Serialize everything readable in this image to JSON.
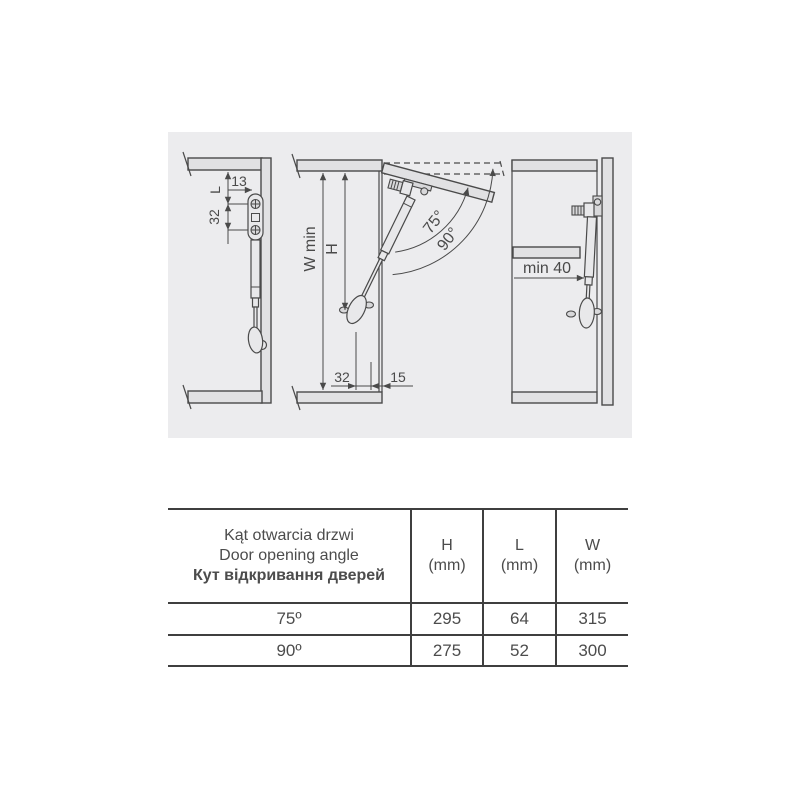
{
  "colors": {
    "page_bg": "#ffffff",
    "diagram_bg": "#ececee",
    "panel_fill": "#e1e1e3",
    "line": "#4a4a4a",
    "text": "#4c4c4c"
  },
  "diagrams": {
    "closed": {
      "dim_offset": "13",
      "dim_l": "L",
      "dim_pitch": "32"
    },
    "open": {
      "dim_width": "W min",
      "dim_height": "H",
      "angle_primary": "75°",
      "angle_secondary": "90°",
      "dim_pitch": "32",
      "dim_front": "15"
    },
    "clearance": {
      "dim_min": "min 40"
    }
  },
  "table": {
    "angle_header": [
      "Kąt otwarcia drzwi",
      "Door opening angle",
      "Кут відкривання дверей"
    ],
    "cols": [
      {
        "label": "H",
        "unit": "(mm)"
      },
      {
        "label": "L",
        "unit": "(mm)"
      },
      {
        "label": "W",
        "unit": "(mm)"
      }
    ],
    "rows": [
      {
        "angle": "75º",
        "values": [
          "295",
          "64",
          "315"
        ]
      },
      {
        "angle": "90º",
        "values": [
          "275",
          "52",
          "300"
        ]
      }
    ]
  }
}
